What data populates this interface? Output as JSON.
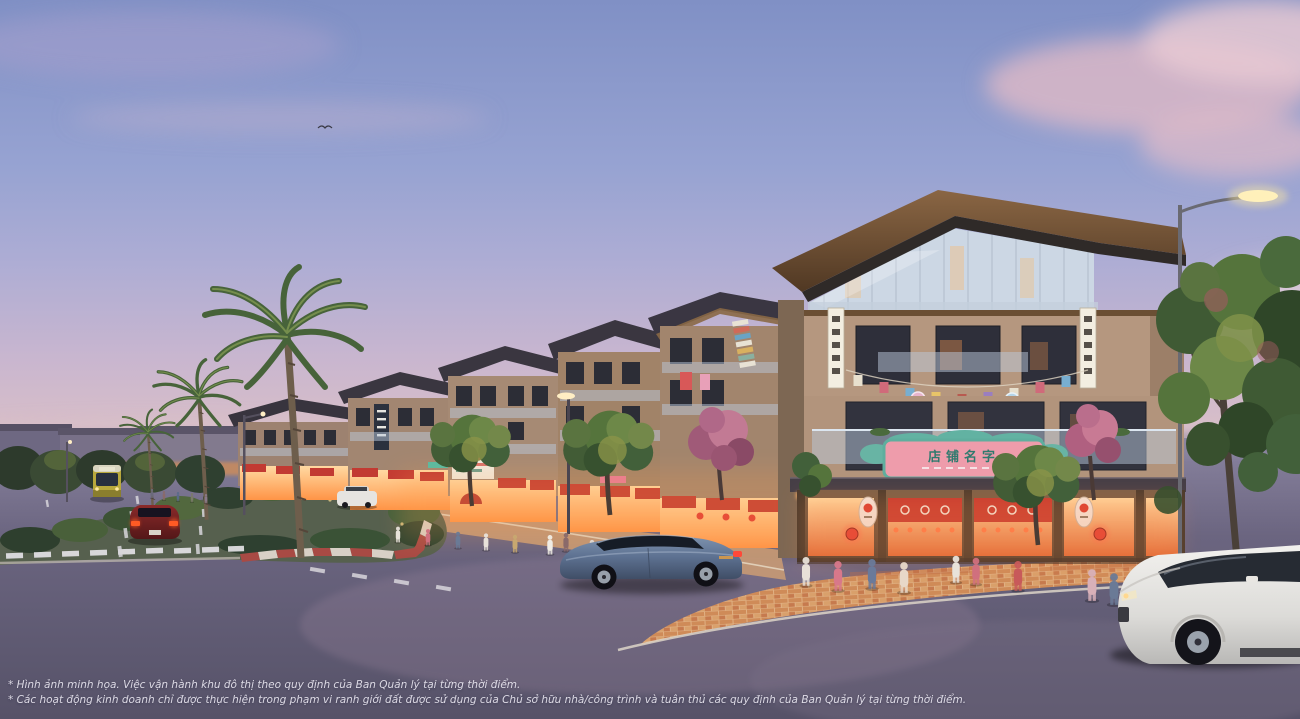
{
  "image": {
    "type": "architectural-rendering",
    "description": "Dusk street view of a shophouse boulevard: lit Asian-themed storefronts, corner shophouse with pink sign and red lanterns, palm trees, landscaped median, bus, cars, white SUV and pedestrians",
    "width": 1300,
    "height": 719
  },
  "disclaimer": {
    "line1": "* Hình ảnh minh họa. Việc vận hành khu đô thị theo quy định của Ban Quản lý tại từng thời điểm.",
    "line2": "* Các hoạt động kinh doanh chỉ được thực hiện trong phạm vi ranh giới đất được sử dụng của Chủ sở hữu nhà/công trình và tuân thủ các quy định của Ban Quản lý tại từng thời điểm."
  },
  "signs": {
    "corner_shop_sign": "店铺名字"
  },
  "colors": {
    "sky_top": "#8090c5",
    "sky_horizon": "#e3c5c3",
    "cloud_pink": "#dfb9c6",
    "roof_bronze": "#7a5a38",
    "wall_tan": "#b5977f",
    "shop_glow": "#ffb45c",
    "awning_red": "#c23a32",
    "lantern_red": "#e23b33",
    "sign_pink": "#ee9cab",
    "sign_teal": "#5fae9e",
    "road": "#635e74",
    "paver_orange": "#cf8b58",
    "median_curb_red": "#a84a44",
    "sedan_blue": "#5c7090",
    "bus_yellow": "#b8a83c"
  }
}
